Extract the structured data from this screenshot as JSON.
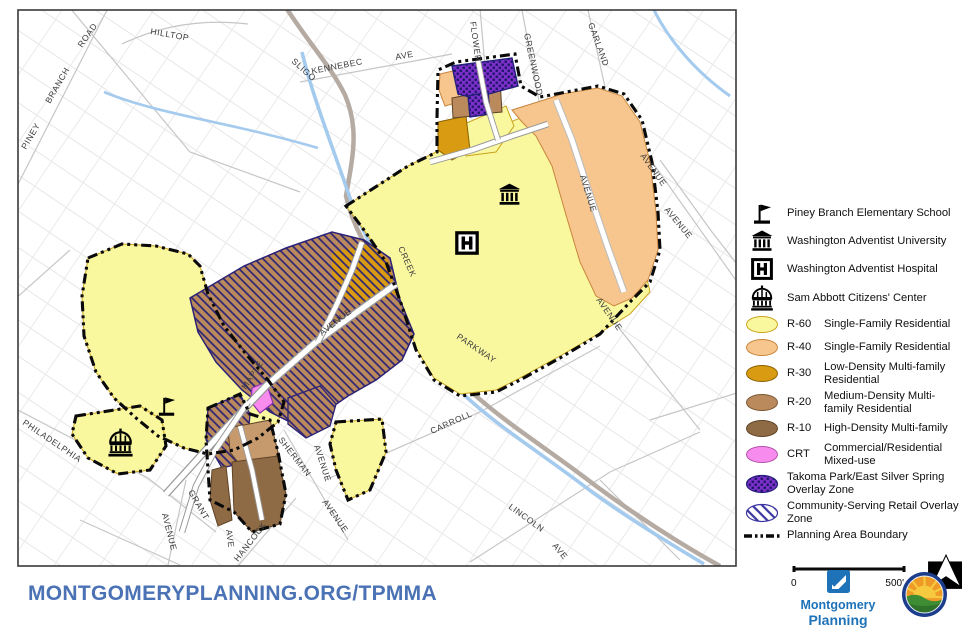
{
  "footer": {
    "url": "MONTGOMERYPLANNING.ORG/TPMMA"
  },
  "branding": {
    "line1": "Montgomery",
    "line2": "Planning",
    "seal": "city-of-takoma-park-seal"
  },
  "colors": {
    "r60": "#FAF89F",
    "r40": "#F7C68E",
    "r30": "#D89B11",
    "r20": "#BB8A5C",
    "r10": "#8F6B45",
    "crt": "#F88CEE",
    "overlay_purple": "#7A2FC8",
    "overlay_navy": "#23207A",
    "boundary": "#0A0A0A",
    "creek": "#A4CBEE",
    "url_blue": "#4A72B5",
    "brand_blue": "#1E72B8"
  },
  "legend": {
    "landmarks": [
      {
        "icon": "flag-icon",
        "label": "Piney Branch Elementary School"
      },
      {
        "icon": "university-icon",
        "label": "Washington Adventist University"
      },
      {
        "icon": "hospital-icon",
        "label": "Washington Adventist Hospital"
      },
      {
        "icon": "dome-icon",
        "label": "Sam Abbott Citizens' Center"
      }
    ],
    "zones": [
      {
        "code": "R-60",
        "label": "Single-Family Residential"
      },
      {
        "code": "R-40",
        "label": "Single-Family Residential"
      },
      {
        "code": "R-30",
        "label": "Low-Density Multi-family Residential"
      },
      {
        "code": "R-20",
        "label": "Medium-Density Multi-family Residential"
      },
      {
        "code": "R-10",
        "label": "High-Density Multi-family"
      },
      {
        "code": "CRT",
        "label": "Commercial/Residential Mixed-use"
      }
    ],
    "overlays": [
      {
        "pattern": "purple-crosshatch",
        "label": "Takoma Park/East Silver Spring Overlay Zone"
      },
      {
        "pattern": "blue-diagonal-stripes",
        "label": "Community-Serving Retail Overlay Zone"
      }
    ],
    "boundary_label": "Planning Area Boundary",
    "scale": {
      "zero": "0",
      "end": "500'"
    }
  },
  "map": {
    "street_labels": [
      "PINEY",
      "BRANCH",
      "ROAD",
      "HILLTOP",
      "SLIGO",
      "KENNEBEC",
      "AVE",
      "FLOWER",
      "GREENWOOD",
      "GARLAND",
      "AVENUE",
      "AVENUE",
      "AVENUE",
      "AVENUE",
      "CREEK",
      "PARKWAY",
      "AVENUE",
      "MAPLE",
      "CARROLL",
      "SHERMAN",
      "AVENUE",
      "AVENUE",
      "LINCOLN",
      "AVE",
      "PHILADELPHIA",
      "GRANT",
      "AVENUE",
      "AVE",
      "HANCOCK"
    ],
    "landmarks": [
      {
        "icon": "flag-icon"
      },
      {
        "icon": "dome-icon"
      },
      {
        "icon": "university-icon"
      },
      {
        "icon": "hospital-icon"
      }
    ]
  }
}
